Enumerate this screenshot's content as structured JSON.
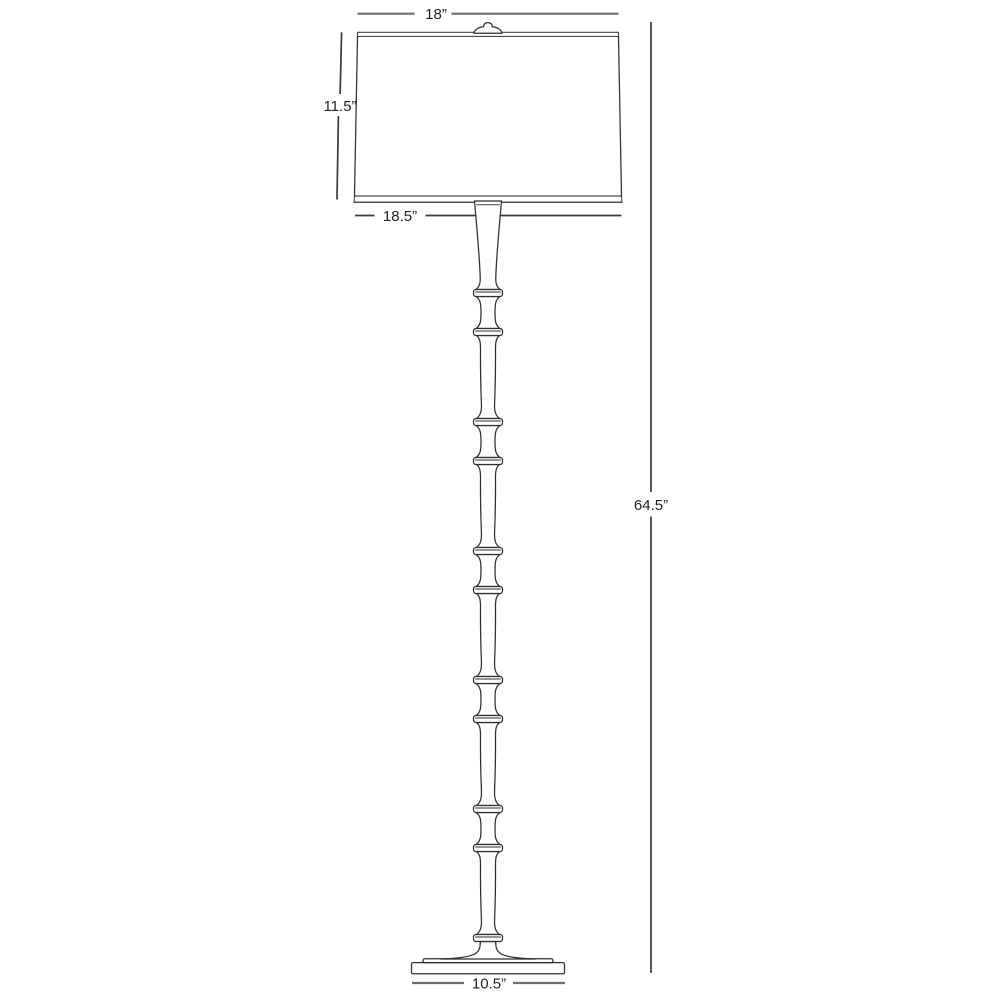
{
  "diagram": {
    "dimensions": {
      "shade_top_width": "18”",
      "shade_height": "11.5”",
      "shade_bottom_width": "18.5”",
      "overall_height": "64.5”",
      "base_width": "10.5”"
    },
    "colors": {
      "outline": "#2e2e2e",
      "dimension_line": "#6f6f6f",
      "dimension_line_dark": "#3a3a3a",
      "label_text": "#231f20",
      "background": "#ffffff"
    }
  }
}
